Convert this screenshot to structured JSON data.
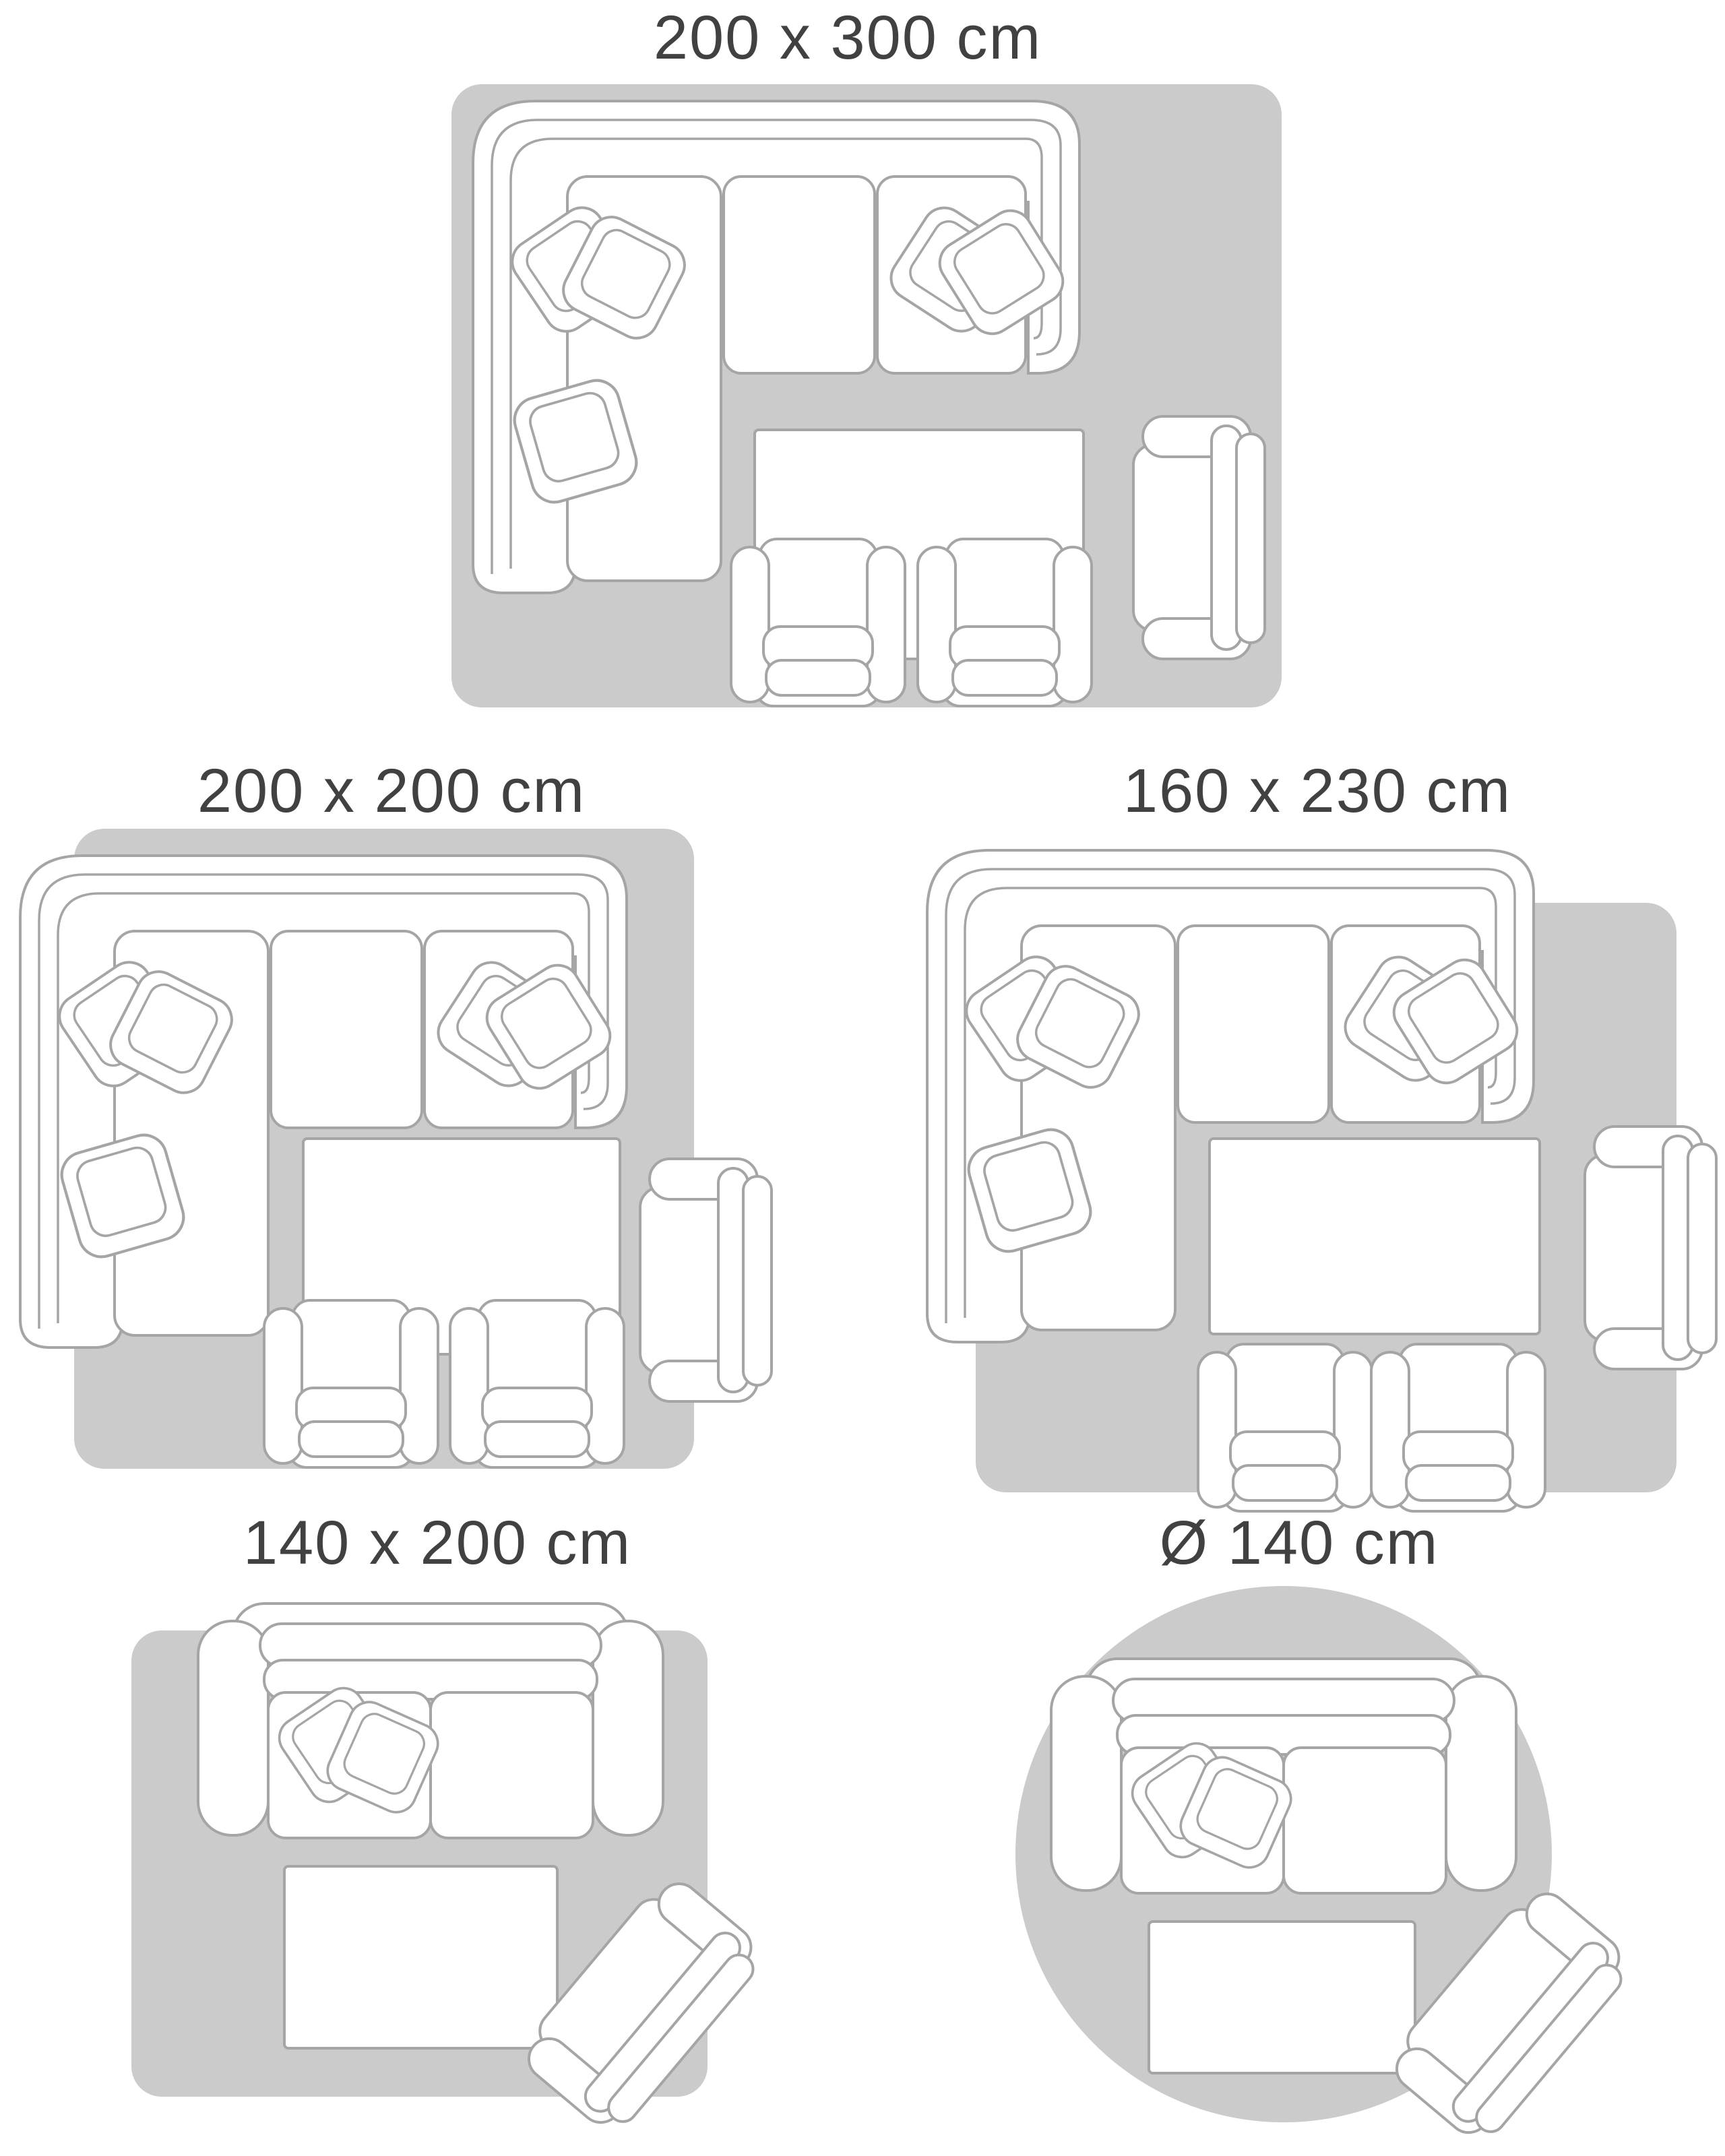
{
  "page": {
    "type": "rug-size-guide-diagram",
    "description": "Top-view living room layouts showing the same furniture on five different rug sizes"
  },
  "colors": {
    "background": "#ffffff",
    "rug_fill": "#cbcbcb",
    "furniture_outline": "#a5a5a5",
    "furniture_fill": "#ffffff",
    "title_text": "#414141"
  },
  "panels": [
    {
      "id": "size-200x300",
      "label": "200 x 300 cm",
      "rug_shape": "rectangle",
      "furniture": [
        "corner-sofa",
        "coffee-table",
        "armchair",
        "side-chair",
        "side-chair"
      ]
    },
    {
      "id": "size-200x200",
      "label": "200 x 200 cm",
      "rug_shape": "square",
      "furniture": [
        "corner-sofa",
        "coffee-table",
        "armchair",
        "side-chair",
        "side-chair"
      ]
    },
    {
      "id": "size-160x230",
      "label": "160 x 230 cm",
      "rug_shape": "rectangle",
      "furniture": [
        "corner-sofa",
        "coffee-table",
        "armchair",
        "side-chair",
        "side-chair"
      ]
    },
    {
      "id": "size-140x200",
      "label": "140 x 200 cm",
      "rug_shape": "rectangle",
      "furniture": [
        "two-seat-sofa",
        "coffee-table",
        "armchair-angled"
      ]
    },
    {
      "id": "size-d140",
      "label": "Ø 140 cm",
      "rug_shape": "circle",
      "furniture": [
        "two-seat-sofa",
        "coffee-table",
        "armchair-angled"
      ]
    }
  ]
}
